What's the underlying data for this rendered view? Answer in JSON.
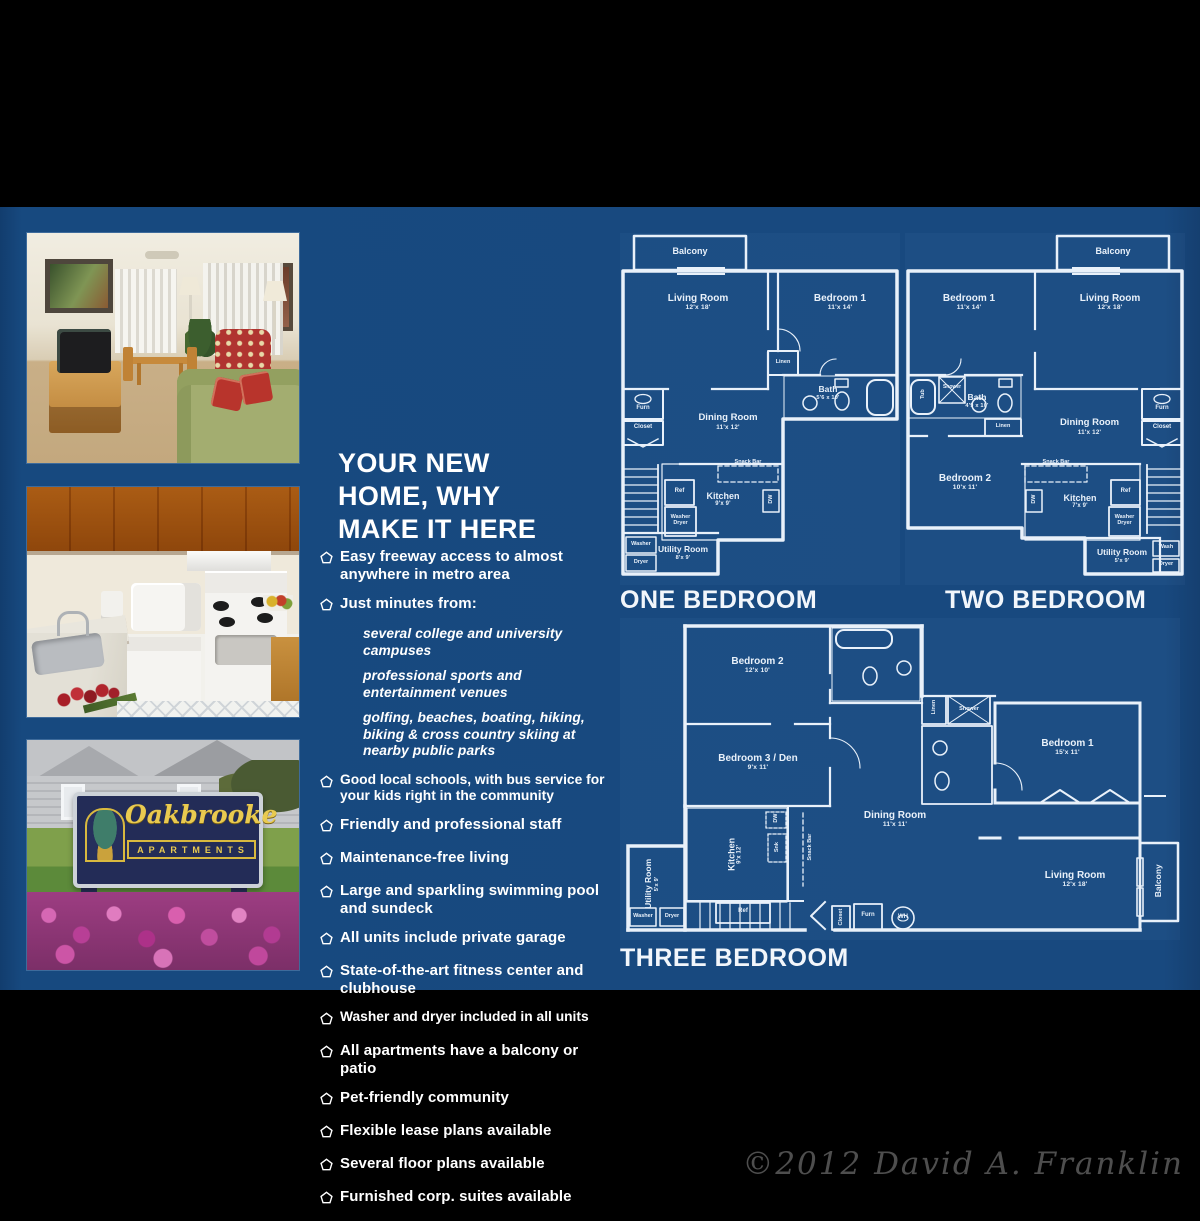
{
  "brand": {
    "sign_name": "Oakbrooke",
    "sign_subtitle": "APARTMENTS",
    "copyright": "©2012 David A. Franklin"
  },
  "headline": {
    "line1": "YOUR NEW",
    "line2": "HOME, WHY",
    "line3": "MAKE IT HERE"
  },
  "features": {
    "bullet_icon": "pentagon-outline",
    "items": [
      {
        "text": "Easy freeway access to almost anywhere in metro area"
      },
      {
        "text": "Just minutes from:",
        "children": [
          "several college and university campuses",
          "professional sports and entertainment venues",
          "golfing, beaches, boating, hiking, biking & cross country skiing at nearby public parks"
        ]
      },
      {
        "text": "Good local schools, with bus service for your kids right in the community"
      },
      {
        "text": "Friendly and professional staff"
      },
      {
        "text": "Maintenance-free living"
      },
      {
        "text": "Large and sparkling swimming pool and sundeck"
      },
      {
        "text": "All units include private garage"
      },
      {
        "text": "State-of-the-art fitness center and clubhouse"
      },
      {
        "text": "Washer and dryer included in all units"
      },
      {
        "text": "All apartments have a balcony or patio"
      },
      {
        "text": "Pet-friendly community"
      },
      {
        "text": "Flexible lease plans available"
      },
      {
        "text": "Several floor plans available"
      },
      {
        "text": "Furnished corp. suites available"
      }
    ]
  },
  "floorplans": {
    "one_bedroom": {
      "caption": "ONE BEDROOM",
      "labels": {
        "balcony": "Balcony",
        "living": {
          "name": "Living Room",
          "dim": "12'x 18'"
        },
        "bedroom1": {
          "name": "Bedroom 1",
          "dim": "11'x 14'"
        },
        "linen": "Linen",
        "bath": {
          "name": "Bath",
          "dim": "5'6 x 10'"
        },
        "dining": {
          "name": "Dining Room",
          "dim": "11'x 12'"
        },
        "furn": "Furn",
        "closet": "Closet",
        "snack": "Snack Bar",
        "kitchen": {
          "name": "Kitchen",
          "dim": "9'x 9'"
        },
        "ref": "Ref",
        "dw": "DW",
        "washer_dryer": "Washer Dryer",
        "utility": {
          "name": "Utility Room",
          "dim": "8'x 9'"
        },
        "washer": "Washer",
        "dryer": "Dryer"
      }
    },
    "two_bedroom": {
      "caption": "TWO BEDROOM",
      "labels": {
        "balcony": "Balcony",
        "bedroom1": {
          "name": "Bedroom 1",
          "dim": "11'x 14'"
        },
        "living": {
          "name": "Living Room",
          "dim": "12'x 18'"
        },
        "shower": "Shower",
        "tub": "Tub",
        "bath": {
          "name": "Bath",
          "dim": "4'9 x 10'"
        },
        "linen": "Linen",
        "bedroom2": {
          "name": "Bedroom 2",
          "dim": "10'x 11'"
        },
        "dining": {
          "name": "Dining Room",
          "dim": "11'x 12'"
        },
        "furn": "Furn",
        "closet": "Closet",
        "snack": "Snack Bar",
        "dw": "DW",
        "kitchen": {
          "name": "Kitchen",
          "dim": "7'x 9'"
        },
        "ref": "Ref",
        "washer_dryer": "Washer Dryer",
        "utility": {
          "name": "Utility Room",
          "dim": "5'x 9'"
        },
        "wash": "Wash",
        "dryer": "Dryer"
      }
    },
    "three_bedroom": {
      "caption": "THREE BEDROOM",
      "labels": {
        "bedroom2": {
          "name": "Bedroom 2",
          "dim": "12'x 10'"
        },
        "bedroom3": {
          "name": "Bedroom 3 / Den",
          "dim": "9'x 11'"
        },
        "bedroom1": {
          "name": "Bedroom 1",
          "dim": "15'x 11'"
        },
        "linen": "Linen",
        "shower": "Shower",
        "dining": {
          "name": "Dining Room",
          "dim": "11'x 11'"
        },
        "living": {
          "name": "Living Room",
          "dim": "12'x 18'"
        },
        "balcony": "Balcony",
        "kitchen": {
          "name": "Kitchen",
          "dim": "9'x 12'"
        },
        "snack": "Snack Bar",
        "snk": "Snk",
        "dw": "DW",
        "ref": "Ref",
        "utility": {
          "name": "Utility Room",
          "dim": "5'x 9'"
        },
        "washer": "Washer",
        "dryer": "Dryer",
        "closet": "Closet",
        "furn": "Furn",
        "wh": "WH"
      }
    }
  }
}
